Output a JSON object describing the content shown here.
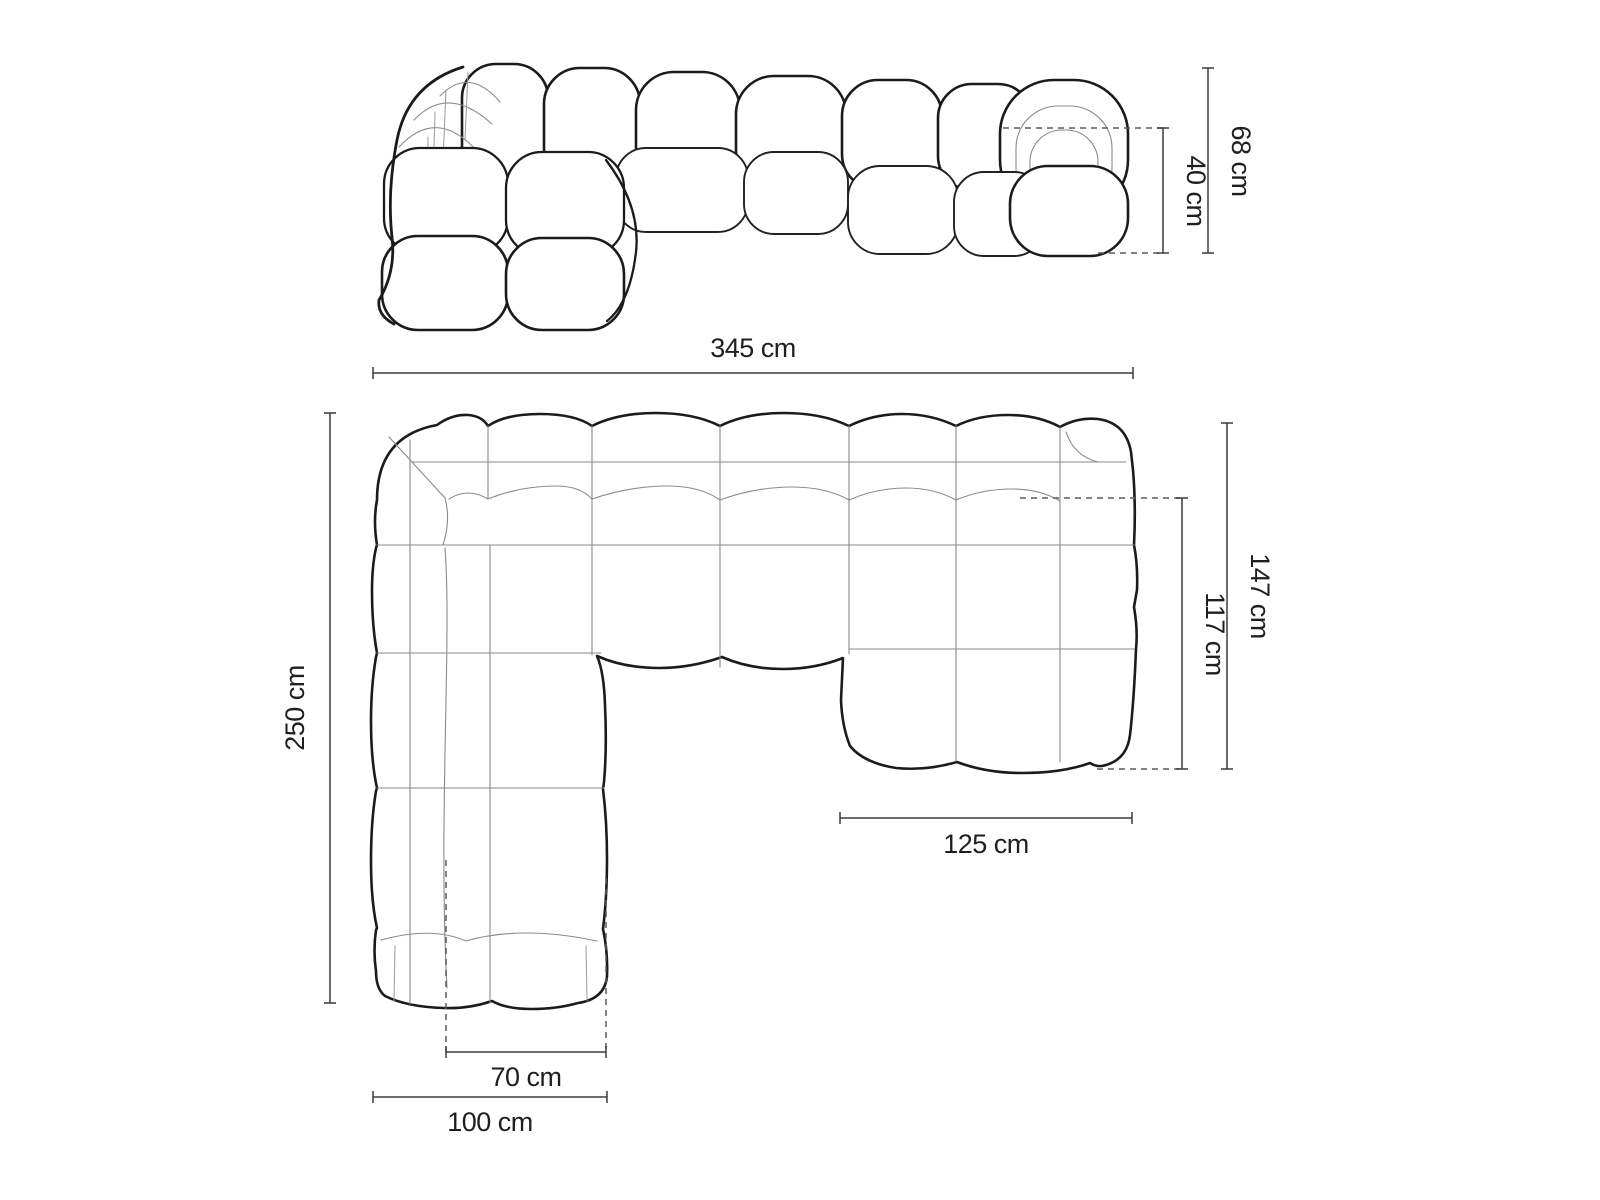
{
  "diagram": {
    "front_view": {
      "total_width": "345 cm",
      "total_height": "68 cm",
      "seat_height": "40 cm"
    },
    "top_view": {
      "total_depth": "250 cm",
      "chaise_total_depth": "147 cm",
      "chaise_clear_depth": "117 cm",
      "chaise_width": "125 cm",
      "seat_column_width": "70 cm",
      "left_section_width": "100 cm"
    },
    "colors": {
      "outline": "#1b1b1b",
      "seam": "#8a8a8a",
      "dimension_line": "#3c3c3c",
      "dashed_line": "#5a5a5a",
      "background": "#ffffff"
    }
  }
}
